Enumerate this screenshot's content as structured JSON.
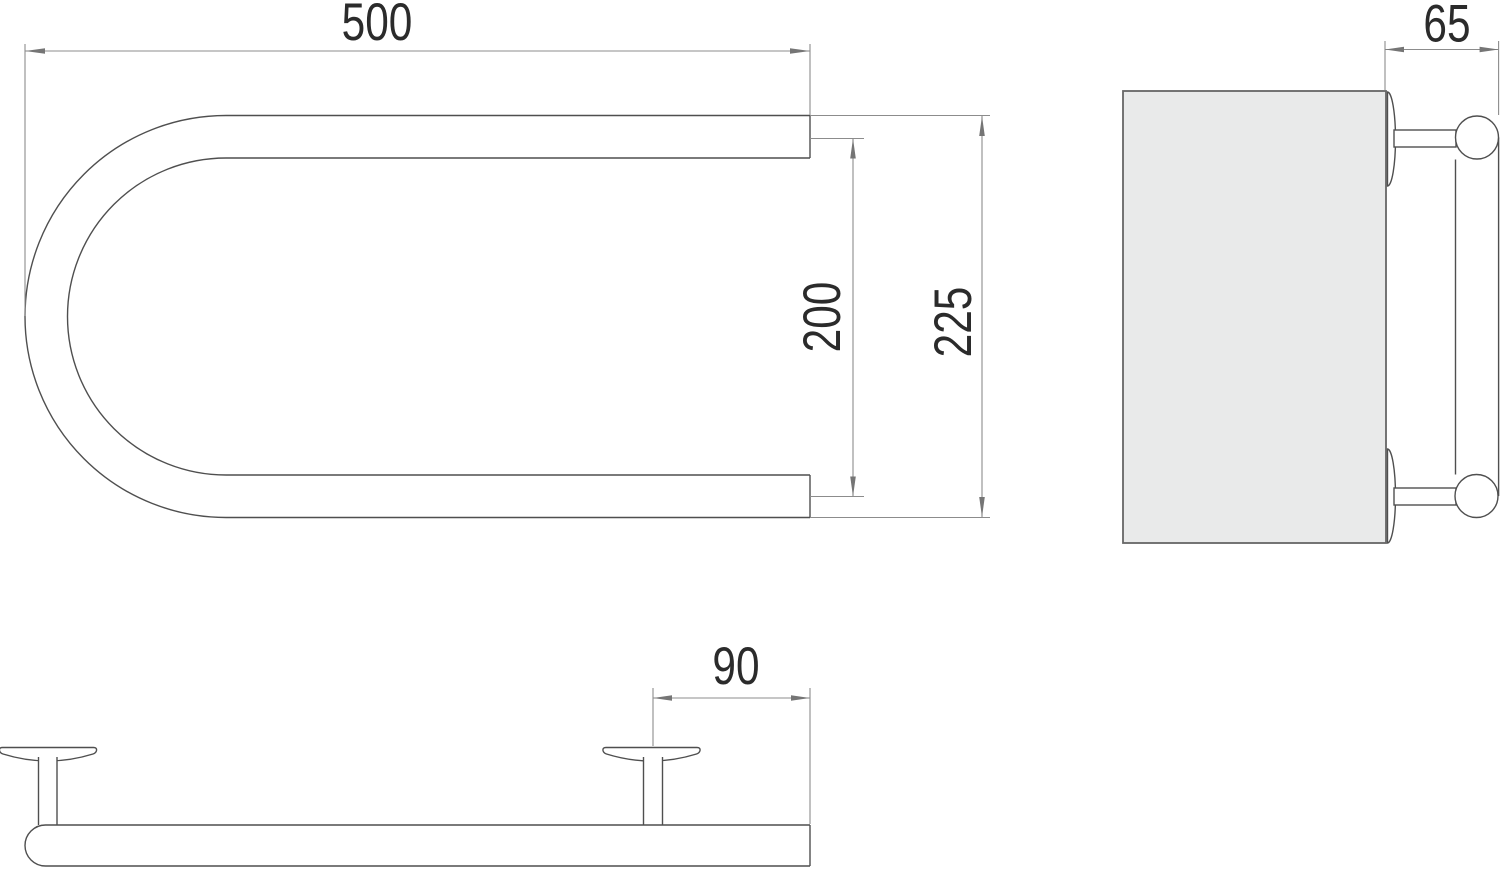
{
  "drawing": {
    "views": {
      "plan": {
        "dim_width": "500",
        "dim_axis_spacing": "200",
        "dim_overall_height": "225"
      },
      "side": {
        "dim_wall_offset": "65"
      },
      "front": {
        "dim_bracket_to_end": "90"
      }
    },
    "colors": {
      "background": "#ffffff",
      "part_outline": "#4f4f4f",
      "dimension_line": "#8c8c8c",
      "text": "#2b2b2b",
      "wall_fill": "#e9eaea"
    }
  }
}
